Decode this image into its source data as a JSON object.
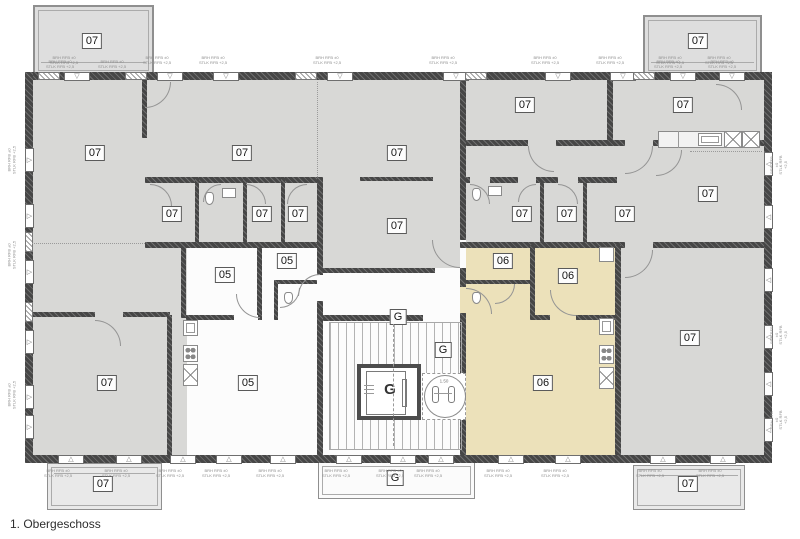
{
  "title": "1. Obergeschoss",
  "colors": {
    "room_gray": "#d8d8d6",
    "unit06_beige": "#ece1ba",
    "wall_dark": "#464646",
    "white_room": "#fcfcfc"
  },
  "plan": {
    "labels": [
      {
        "t": "07",
        "x": 92,
        "y": 41
      },
      {
        "t": "07",
        "x": 698,
        "y": 41
      },
      {
        "t": "07",
        "x": 95,
        "y": 153
      },
      {
        "t": "07",
        "x": 242,
        "y": 153
      },
      {
        "t": "07",
        "x": 397,
        "y": 153
      },
      {
        "t": "07",
        "x": 525,
        "y": 105
      },
      {
        "t": "07",
        "x": 683,
        "y": 105
      },
      {
        "t": "07",
        "x": 172,
        "y": 214
      },
      {
        "t": "07",
        "x": 262,
        "y": 214
      },
      {
        "t": "07",
        "x": 298,
        "y": 214
      },
      {
        "t": "07",
        "x": 397,
        "y": 226
      },
      {
        "t": "07",
        "x": 522,
        "y": 214
      },
      {
        "t": "07",
        "x": 567,
        "y": 214
      },
      {
        "t": "07",
        "x": 625,
        "y": 214
      },
      {
        "t": "07",
        "x": 708,
        "y": 194
      },
      {
        "t": "05",
        "x": 287,
        "y": 261
      },
      {
        "t": "05",
        "x": 225,
        "y": 275
      },
      {
        "t": "05",
        "x": 248,
        "y": 383
      },
      {
        "t": "06",
        "x": 503,
        "y": 261
      },
      {
        "t": "06",
        "x": 568,
        "y": 276
      },
      {
        "t": "06",
        "x": 543,
        "y": 383
      },
      {
        "t": "07",
        "x": 690,
        "y": 338
      },
      {
        "t": "07",
        "x": 107,
        "y": 383
      },
      {
        "t": "G",
        "x": 398,
        "y": 317
      },
      {
        "t": "G",
        "x": 443,
        "y": 350
      },
      {
        "t": "G",
        "x": 395,
        "y": 478
      },
      {
        "t": "07",
        "x": 103,
        "y": 484
      },
      {
        "t": "07",
        "x": 688,
        "y": 484
      },
      {
        "t": "G",
        "x": 390,
        "y": 390,
        "plain": true
      }
    ],
    "windows": {
      "top_x": [
        64,
        157,
        213,
        327,
        443,
        545,
        610,
        670,
        719
      ],
      "bottom_x": [
        58,
        116,
        170,
        216,
        270,
        336,
        390,
        428,
        498,
        555,
        650,
        710
      ],
      "left_y": [
        148,
        204,
        260,
        330,
        385,
        415
      ],
      "right_y": [
        152,
        205,
        268,
        325,
        372,
        418
      ],
      "piers_top_x": [
        38,
        125,
        295,
        465,
        633
      ],
      "piers_left_y": [
        232,
        302
      ]
    },
    "doors": [
      [
        145,
        82,
        26,
        "br"
      ],
      [
        150,
        184,
        22,
        "tr"
      ],
      [
        203,
        184,
        18,
        "tl"
      ],
      [
        246,
        184,
        20,
        "tr"
      ],
      [
        287,
        184,
        20,
        "tl"
      ],
      [
        236,
        294,
        24,
        "bl"
      ],
      [
        280,
        288,
        20,
        "br"
      ],
      [
        298,
        274,
        22,
        "tl"
      ],
      [
        95,
        320,
        26,
        "tr"
      ],
      [
        432,
        240,
        28,
        "bl"
      ],
      [
        466,
        288,
        26,
        "tr"
      ],
      [
        495,
        284,
        20,
        "br"
      ],
      [
        550,
        290,
        26,
        "bl"
      ],
      [
        470,
        184,
        20,
        "tr"
      ],
      [
        518,
        184,
        18,
        "tl"
      ],
      [
        558,
        184,
        20,
        "tr"
      ],
      [
        528,
        146,
        26,
        "bl"
      ],
      [
        625,
        146,
        28,
        "br"
      ],
      [
        625,
        250,
        28,
        "br"
      ],
      [
        716,
        84,
        26,
        "tr"
      ],
      [
        656,
        150,
        26,
        "br"
      ]
    ],
    "dotted": [
      [
        32,
        243,
        113,
        0,
        "h"
      ],
      [
        317,
        82,
        95,
        0,
        "v"
      ],
      [
        690,
        151,
        72,
        0,
        "h"
      ],
      [
        393,
        324,
        122,
        0,
        "vd"
      ]
    ],
    "notes": {
      "line1": "BRH RFB ±0",
      "line2": "STLK RFB +2,5",
      "positions": [
        [
          64,
          56,
          0
        ],
        [
          157,
          56,
          0
        ],
        [
          213,
          56,
          0
        ],
        [
          327,
          56,
          0
        ],
        [
          443,
          56,
          0
        ],
        [
          545,
          56,
          0
        ],
        [
          610,
          56,
          0
        ],
        [
          670,
          56,
          0
        ],
        [
          719,
          56,
          0
        ],
        [
          60,
          60,
          0
        ],
        [
          112,
          60,
          0
        ],
        [
          668,
          60,
          0
        ],
        [
          722,
          60,
          0
        ],
        [
          58,
          469,
          0
        ],
        [
          116,
          469,
          0
        ],
        [
          170,
          469,
          0
        ],
        [
          216,
          469,
          0
        ],
        [
          270,
          469,
          0
        ],
        [
          336,
          469,
          0
        ],
        [
          390,
          469,
          0
        ],
        [
          428,
          469,
          0
        ],
        [
          498,
          469,
          0
        ],
        [
          555,
          469,
          0
        ],
        [
          650,
          469,
          0
        ],
        [
          710,
          469,
          0
        ],
        [
          12,
          160,
          90
        ],
        [
          12,
          255,
          90
        ],
        [
          12,
          395,
          90
        ],
        [
          779,
          165,
          90
        ],
        [
          779,
          335,
          90
        ],
        [
          779,
          420,
          90
        ]
      ]
    },
    "turning_radius_label": "1.50"
  }
}
